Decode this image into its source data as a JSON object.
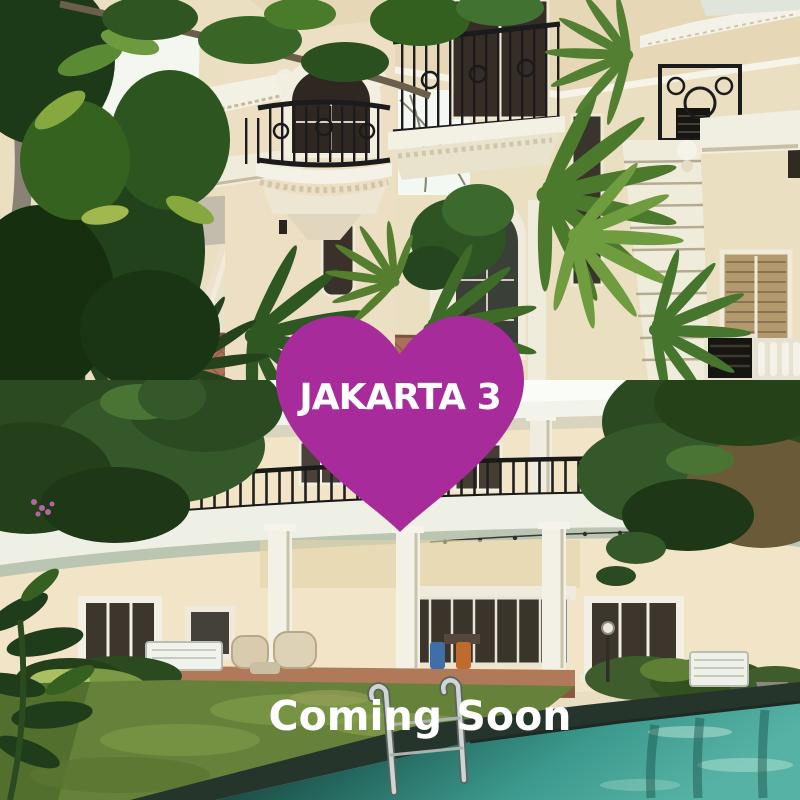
{
  "overlay": {
    "badge": {
      "label": "JAKARTA 3"
    },
    "coming_soon": {
      "label": "Coming Soon"
    }
  },
  "colors": {
    "heart_purple": "#a82b9c",
    "text_white": "#ffffff",
    "pool_teal": "#3d9a8e",
    "pool_shadow": "#152019",
    "lawn_green": "#66813a",
    "wall_cream": "#ebdfc2",
    "trim_white": "#f2f0e4",
    "railing_black": "#1c1c1e",
    "foliage_green": "#2e5322",
    "coping_dark": "#26352c",
    "sky_white": "#f7faf4",
    "brick_orange": "#b5643c",
    "tile_terracotta": "#a8725a"
  },
  "photos": {
    "top": {
      "description": "Three-story classical villa facade with wrought-iron balconies, marble column and tropical palms"
    },
    "bottom": {
      "description": "Two-story cream villa with curved balcony, lawn and swimming pool"
    }
  }
}
